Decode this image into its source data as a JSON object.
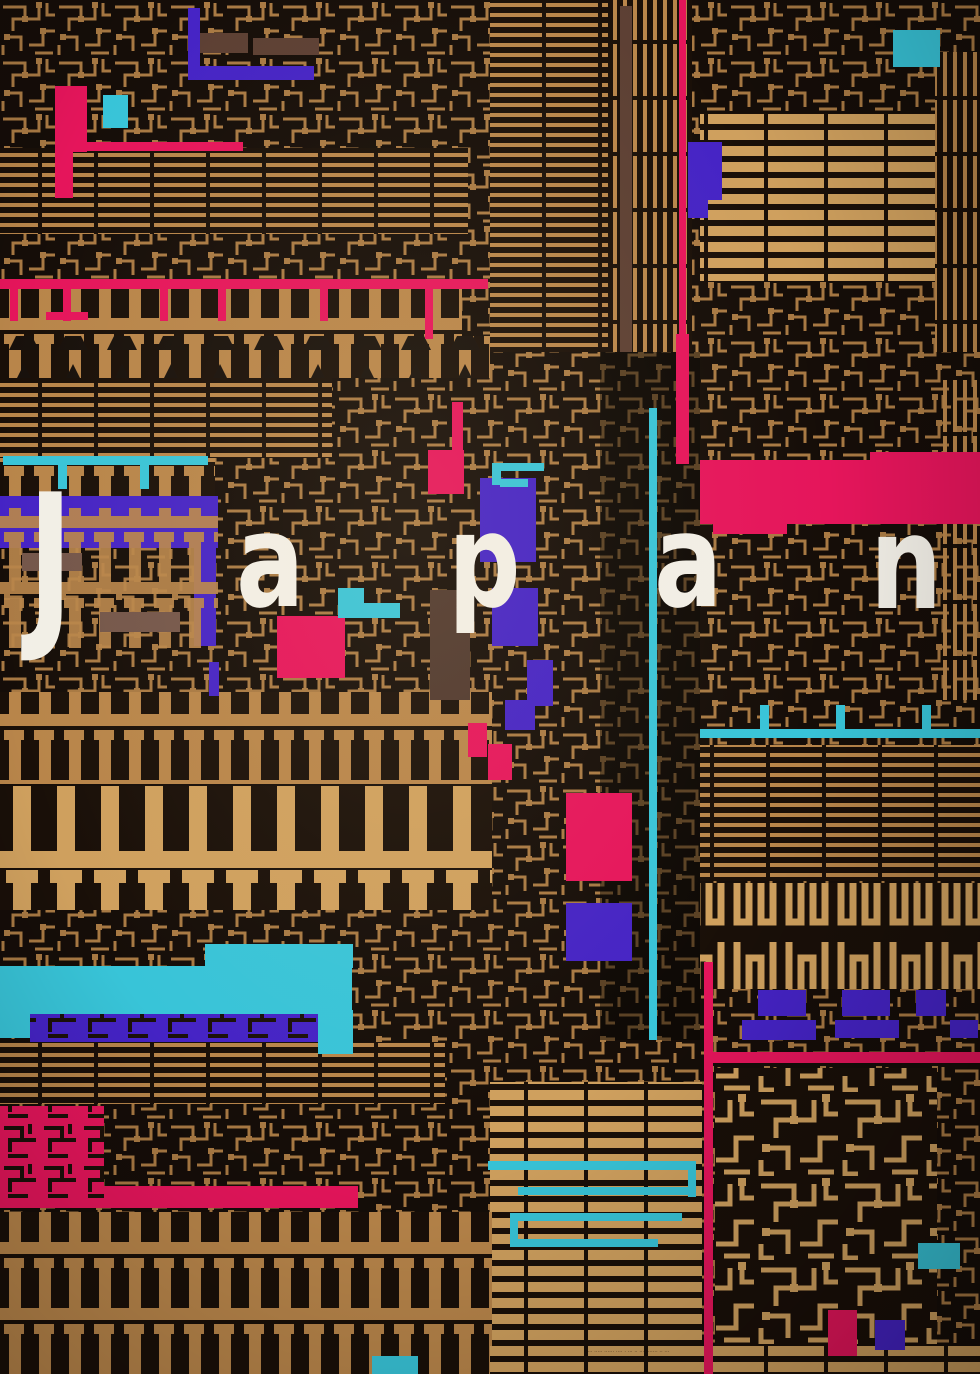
{
  "poster": {
    "title": "Japan",
    "letters": [
      "J",
      "a",
      "p",
      "a",
      "n"
    ],
    "credit_microtext": "···· ····· ······ ···· · ··· ·· ···· ······ ·· ···"
  },
  "palette": {
    "bg": "#150d08",
    "panel_dark": "#190f08",
    "gold_bright": "#cfa05e",
    "gold_mid": "#b8854a",
    "gold_dim": "#8a5c30",
    "maroon": "#5c3f33",
    "mauve": "#74564a",
    "magenta": "#e5155b",
    "purple": "#4523c5",
    "purple_dark": "#2c1585",
    "cyan": "#38c4d8",
    "letter_white": "#f2efe7"
  }
}
